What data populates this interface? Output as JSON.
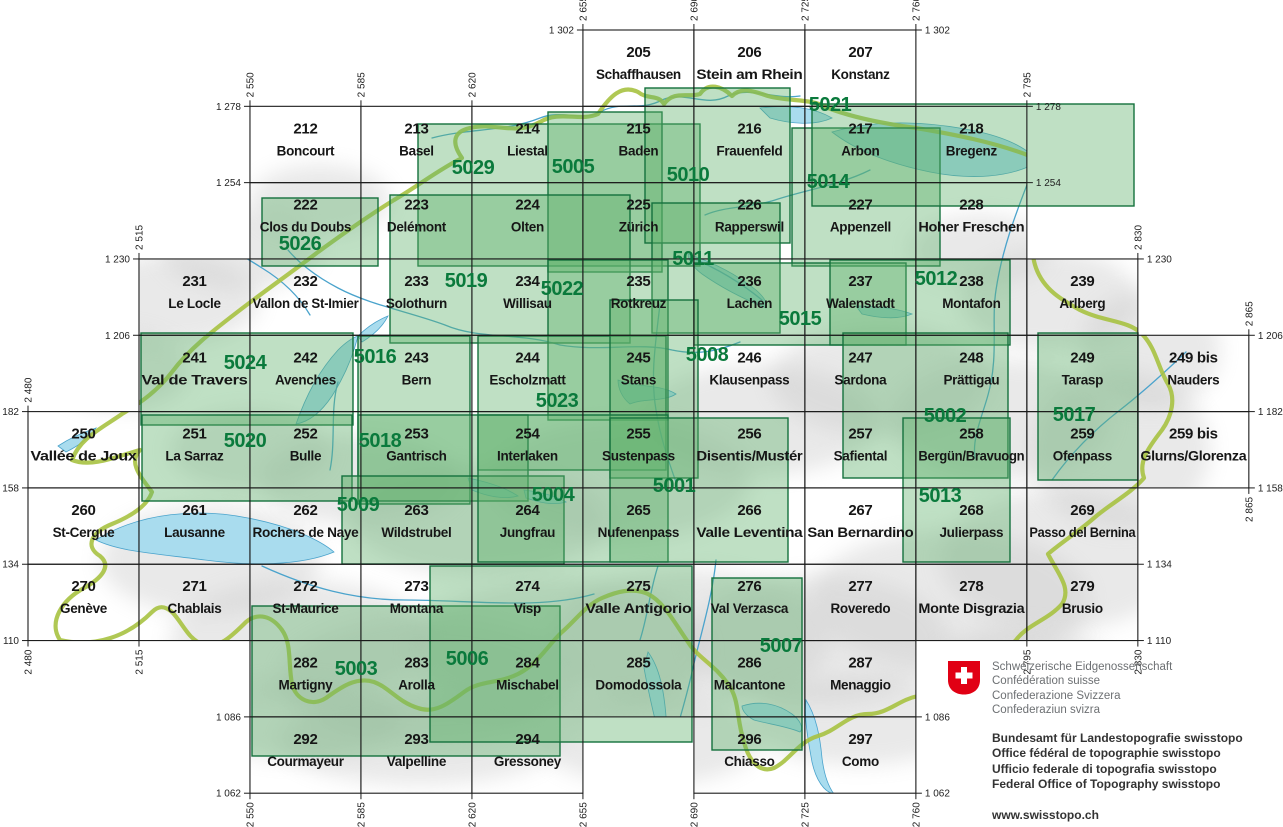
{
  "map": {
    "sheets": [
      {
        "num": "205",
        "name": "Schaffhausen",
        "e": 2655,
        "n": 1302
      },
      {
        "num": "206",
        "name": "Stein am Rhein",
        "e": 2690,
        "n": 1302
      },
      {
        "num": "207",
        "name": "Konstanz",
        "e": 2725,
        "n": 1302
      },
      {
        "num": "212",
        "name": "Boncourt",
        "e": 2550,
        "n": 1278
      },
      {
        "num": "213",
        "name": "Basel",
        "e": 2585,
        "n": 1278
      },
      {
        "num": "214",
        "name": "Liestal",
        "e": 2620,
        "n": 1278
      },
      {
        "num": "215",
        "name": "Baden",
        "e": 2655,
        "n": 1278
      },
      {
        "num": "216",
        "name": "Frauenfeld",
        "e": 2690,
        "n": 1278
      },
      {
        "num": "217",
        "name": "Arbon",
        "e": 2725,
        "n": 1278
      },
      {
        "num": "218",
        "name": "Bregenz",
        "e": 2760,
        "n": 1278
      },
      {
        "num": "222",
        "name": "Clos du Doubs",
        "e": 2550,
        "n": 1254
      },
      {
        "num": "223",
        "name": "Delémont",
        "e": 2585,
        "n": 1254
      },
      {
        "num": "224",
        "name": "Olten",
        "e": 2620,
        "n": 1254
      },
      {
        "num": "225",
        "name": "Zürich",
        "e": 2655,
        "n": 1254
      },
      {
        "num": "226",
        "name": "Rapperswil",
        "e": 2690,
        "n": 1254
      },
      {
        "num": "227",
        "name": "Appenzell",
        "e": 2725,
        "n": 1254
      },
      {
        "num": "228",
        "name": "Hoher Freschen",
        "e": 2760,
        "n": 1254
      },
      {
        "num": "231",
        "name": "Le Locle",
        "e": 2515,
        "n": 1230
      },
      {
        "num": "232",
        "name": "Vallon de St-Imier",
        "e": 2550,
        "n": 1230
      },
      {
        "num": "233",
        "name": "Solothurn",
        "e": 2585,
        "n": 1230
      },
      {
        "num": "234",
        "name": "Willisau",
        "e": 2620,
        "n": 1230
      },
      {
        "num": "235",
        "name": "Rotkreuz",
        "e": 2655,
        "n": 1230
      },
      {
        "num": "236",
        "name": "Lachen",
        "e": 2690,
        "n": 1230
      },
      {
        "num": "237",
        "name": "Walenstadt",
        "e": 2725,
        "n": 1230
      },
      {
        "num": "238",
        "name": "Montafon",
        "e": 2760,
        "n": 1230
      },
      {
        "num": "239",
        "name": "Arlberg",
        "e": 2795,
        "n": 1230
      },
      {
        "num": "241",
        "name": "Val de Travers",
        "e": 2515,
        "n": 1206
      },
      {
        "num": "242",
        "name": "Avenches",
        "e": 2550,
        "n": 1206
      },
      {
        "num": "243",
        "name": "Bern",
        "e": 2585,
        "n": 1206
      },
      {
        "num": "244",
        "name": "Escholzmatt",
        "e": 2620,
        "n": 1206
      },
      {
        "num": "245",
        "name": "Stans",
        "e": 2655,
        "n": 1206
      },
      {
        "num": "246",
        "name": "Klausenpass",
        "e": 2690,
        "n": 1206
      },
      {
        "num": "247",
        "name": "Sardona",
        "e": 2725,
        "n": 1206
      },
      {
        "num": "248",
        "name": "Prättigau",
        "e": 2760,
        "n": 1206
      },
      {
        "num": "249",
        "name": "Tarasp",
        "e": 2795,
        "n": 1206
      },
      {
        "num": "249 bis",
        "name": "Nauders",
        "e": 2830,
        "n": 1206
      },
      {
        "num": "250",
        "name": "Vallée de Joux",
        "e": 2480,
        "n": 1182
      },
      {
        "num": "251",
        "name": "La Sarraz",
        "e": 2515,
        "n": 1182
      },
      {
        "num": "252",
        "name": "Bulle",
        "e": 2550,
        "n": 1182
      },
      {
        "num": "253",
        "name": "Gantrisch",
        "e": 2585,
        "n": 1182
      },
      {
        "num": "254",
        "name": "Interlaken",
        "e": 2620,
        "n": 1182
      },
      {
        "num": "255",
        "name": "Sustenpass",
        "e": 2655,
        "n": 1182
      },
      {
        "num": "256",
        "name": "Disentis/Mustér",
        "e": 2690,
        "n": 1182
      },
      {
        "num": "257",
        "name": "Safiental",
        "e": 2725,
        "n": 1182
      },
      {
        "num": "258",
        "name": "Bergün/Bravuogn",
        "e": 2760,
        "n": 1182
      },
      {
        "num": "259",
        "name": "Ofenpass",
        "e": 2795,
        "n": 1182
      },
      {
        "num": "259 bis",
        "name": "Glurns/Glorenza",
        "e": 2830,
        "n": 1182
      },
      {
        "num": "260",
        "name": "St-Cergue",
        "e": 2480,
        "n": 1158
      },
      {
        "num": "261",
        "name": "Lausanne",
        "e": 2515,
        "n": 1158
      },
      {
        "num": "262",
        "name": "Rochers de Naye",
        "e": 2550,
        "n": 1158
      },
      {
        "num": "263",
        "name": "Wildstrubel",
        "e": 2585,
        "n": 1158
      },
      {
        "num": "264",
        "name": "Jungfrau",
        "e": 2620,
        "n": 1158
      },
      {
        "num": "265",
        "name": "Nufenenpass",
        "e": 2655,
        "n": 1158
      },
      {
        "num": "266",
        "name": "Valle Leventina",
        "e": 2690,
        "n": 1158
      },
      {
        "num": "267",
        "name": "San Bernardino",
        "e": 2725,
        "n": 1158
      },
      {
        "num": "268",
        "name": "Julierpass",
        "e": 2760,
        "n": 1158
      },
      {
        "num": "269",
        "name": "Passo del Bernina",
        "e": 2795,
        "n": 1158
      },
      {
        "num": "270",
        "name": "Genève",
        "e": 2480,
        "n": 1134
      },
      {
        "num": "271",
        "name": "Chablais",
        "e": 2515,
        "n": 1134
      },
      {
        "num": "272",
        "name": "St-Maurice",
        "e": 2550,
        "n": 1134
      },
      {
        "num": "273",
        "name": "Montana",
        "e": 2585,
        "n": 1134
      },
      {
        "num": "274",
        "name": "Visp",
        "e": 2620,
        "n": 1134
      },
      {
        "num": "275",
        "name": "Valle Antigorio",
        "e": 2655,
        "n": 1134
      },
      {
        "num": "276",
        "name": "Val Verzasca",
        "e": 2690,
        "n": 1134
      },
      {
        "num": "277",
        "name": "Roveredo",
        "e": 2725,
        "n": 1134
      },
      {
        "num": "278",
        "name": "Monte Disgrazia",
        "e": 2760,
        "n": 1134
      },
      {
        "num": "279",
        "name": "Brusio",
        "e": 2795,
        "n": 1134
      },
      {
        "num": "282",
        "name": "Martigny",
        "e": 2550,
        "n": 1110
      },
      {
        "num": "283",
        "name": "Arolla",
        "e": 2585,
        "n": 1110
      },
      {
        "num": "284",
        "name": "Mischabel",
        "e": 2620,
        "n": 1110
      },
      {
        "num": "285",
        "name": "Domodossola",
        "e": 2655,
        "n": 1110
      },
      {
        "num": "286",
        "name": "Malcantone",
        "e": 2690,
        "n": 1110
      },
      {
        "num": "287",
        "name": "Menaggio",
        "e": 2725,
        "n": 1110
      },
      {
        "num": "292",
        "name": "Courmayeur",
        "e": 2550,
        "n": 1086
      },
      {
        "num": "293",
        "name": "Valpelline",
        "e": 2585,
        "n": 1086
      },
      {
        "num": "294",
        "name": "Gressoney",
        "e": 2620,
        "n": 1086
      },
      {
        "num": "296",
        "name": "Chiasso",
        "e": 2690,
        "n": 1086
      },
      {
        "num": "297",
        "name": "Como",
        "e": 2725,
        "n": 1086
      }
    ],
    "composites": [
      {
        "num": "5029",
        "x": 418,
        "y": 124,
        "w": 282,
        "h": 142,
        "lx": 473,
        "ly": 167
      },
      {
        "num": "5005",
        "x": 548,
        "y": 112,
        "w": 114,
        "h": 160,
        "lx": 573,
        "ly": 166
      },
      {
        "num": "5010",
        "x": 645,
        "y": 88,
        "w": 145,
        "h": 155,
        "lx": 688,
        "ly": 174
      },
      {
        "num": "5014",
        "x": 792,
        "y": 128,
        "w": 148,
        "h": 138,
        "lx": 828,
        "ly": 181
      },
      {
        "num": "5021",
        "x": 812,
        "y": 104,
        "w": 322,
        "h": 102,
        "lx": 830,
        "ly": 104
      },
      {
        "num": "5026",
        "x": 262,
        "y": 198,
        "w": 116,
        "h": 68,
        "lx": 300,
        "ly": 243
      },
      {
        "num": "5019",
        "x": 390,
        "y": 195,
        "w": 240,
        "h": 148,
        "lx": 466,
        "ly": 280
      },
      {
        "num": "5011",
        "x": 652,
        "y": 203,
        "w": 128,
        "h": 130,
        "lx": 693,
        "ly": 258
      },
      {
        "num": "5022",
        "x": 548,
        "y": 260,
        "w": 120,
        "h": 160,
        "lx": 562,
        "ly": 288
      },
      {
        "num": "5015",
        "x": 694,
        "y": 263,
        "w": 212,
        "h": 82,
        "lx": 800,
        "ly": 318
      },
      {
        "num": "5012",
        "x": 830,
        "y": 260,
        "w": 180,
        "h": 85,
        "lx": 936,
        "ly": 278
      },
      {
        "num": "5024",
        "x": 141,
        "y": 333,
        "w": 212,
        "h": 92,
        "lx": 245,
        "ly": 362
      },
      {
        "num": "5016",
        "x": 358,
        "y": 336,
        "w": 112,
        "h": 168,
        "lx": 375,
        "ly": 356
      },
      {
        "num": "5023",
        "x": 478,
        "y": 336,
        "w": 188,
        "h": 134,
        "lx": 557,
        "ly": 400
      },
      {
        "num": "5008",
        "x": 610,
        "y": 300,
        "w": 88,
        "h": 178,
        "lx": 707,
        "ly": 354
      },
      {
        "num": "5002",
        "x": 843,
        "y": 333,
        "w": 165,
        "h": 145,
        "lx": 945,
        "ly": 415
      },
      {
        "num": "5017",
        "x": 1038,
        "y": 333,
        "w": 100,
        "h": 147,
        "lx": 1074,
        "ly": 414
      },
      {
        "num": "5020",
        "x": 142,
        "y": 415,
        "w": 210,
        "h": 86,
        "lx": 245,
        "ly": 440
      },
      {
        "num": "5018",
        "x": 358,
        "y": 415,
        "w": 170,
        "h": 86,
        "lx": 380,
        "ly": 440
      },
      {
        "num": "5009",
        "x": 342,
        "y": 476,
        "w": 222,
        "h": 88,
        "lx": 358,
        "ly": 504
      },
      {
        "num": "5004",
        "x": 478,
        "y": 415,
        "w": 190,
        "h": 147,
        "lx": 553,
        "ly": 494
      },
      {
        "num": "5001",
        "x": 610,
        "y": 418,
        "w": 178,
        "h": 144,
        "lx": 674,
        "ly": 485
      },
      {
        "num": "5013",
        "x": 903,
        "y": 418,
        "w": 107,
        "h": 144,
        "lx": 940,
        "ly": 495
      },
      {
        "num": "5007",
        "x": 712,
        "y": 578,
        "w": 90,
        "h": 172,
        "lx": 781,
        "ly": 645
      },
      {
        "num": "5003",
        "x": 252,
        "y": 606,
        "w": 308,
        "h": 150,
        "lx": 356,
        "ly": 668
      },
      {
        "num": "5006",
        "x": 430,
        "y": 566,
        "w": 262,
        "h": 176,
        "lx": 467,
        "ly": 658
      }
    ],
    "northings": [
      {
        "v": "1 302",
        "n": 1302,
        "w": 2655,
        "e": 2760
      },
      {
        "v": "1 278",
        "n": 1278,
        "w": 2550,
        "e": 2795
      },
      {
        "v": "1 254",
        "n": 1254,
        "w": 2550,
        "e": 2795
      },
      {
        "v": "1 230",
        "n": 1230,
        "w": 2515,
        "e": 2830
      },
      {
        "v": "1 206",
        "n": 1206,
        "w": 2515,
        "e": 2865
      },
      {
        "v": "1 182",
        "n": 1182,
        "w": 2480,
        "e": 2865
      },
      {
        "v": "1 158",
        "n": 1158,
        "w": 2480,
        "e": 2865
      },
      {
        "v": "1 134",
        "n": 1134,
        "w": 2480,
        "e": 2830
      },
      {
        "v": "1 110",
        "n": 1110,
        "w": 2480,
        "e": 2830
      },
      {
        "v": "1 086",
        "n": 1086,
        "w": 2550,
        "e": 2760
      },
      {
        "v": "1 062",
        "n": 1062,
        "w": 2550,
        "e": 2760
      }
    ],
    "eastings": [
      {
        "v": "2 480",
        "e": 2480,
        "top": 1182,
        "bot": 1110
      },
      {
        "v": "2 515",
        "e": 2515,
        "top": 1230,
        "bot": 1110
      },
      {
        "v": "2 550",
        "e": 2550,
        "top": 1278,
        "bot": 1062
      },
      {
        "v": "2 585",
        "e": 2585,
        "top": 1278,
        "bot": 1062
      },
      {
        "v": "2 620",
        "e": 2620,
        "top": 1278,
        "bot": 1062
      },
      {
        "v": "2 655",
        "e": 2655,
        "top": 1302,
        "bot": 1062
      },
      {
        "v": "2 690",
        "e": 2690,
        "top": 1302,
        "bot": 1062
      },
      {
        "v": "2 725",
        "e": 2725,
        "top": 1302,
        "bot": 1062
      },
      {
        "v": "2 760",
        "e": 2760,
        "top": 1302,
        "bot": 1062
      },
      {
        "v": "2 795",
        "e": 2795,
        "top": 1278,
        "bot": 1110
      },
      {
        "v": "2 830",
        "e": 2830,
        "top": 1230,
        "bot": 1110
      },
      {
        "v": "2 865",
        "e": 2865,
        "top": 1206,
        "bot": 1158
      }
    ]
  },
  "logo": {
    "confederation_lines": [
      "Schweizerische Eidgenossenschaft",
      "Confédération suisse",
      "Confederazione Svizzera",
      "Confederaziun svizra"
    ],
    "office_lines": [
      "Bundesamt für Landestopografie swisstopo",
      "Office fédéral de topographie swisstopo",
      "Ufficio federale di topografia swisstopo",
      "Federal Office of Topography swisstopo"
    ],
    "url": "www.swisstopo.ch"
  },
  "colors": {
    "composite_green": "#0a7a3c",
    "overlay_fill": "rgba(96,178,108,0.40)",
    "overlay_stroke": "#14713d",
    "border_green": "#a8c242",
    "water_fill": "#a9dcee",
    "water_line": "#4aa3cc",
    "river_blue": "#4aa3cc",
    "logo_red": "#e10014",
    "grid_black": "#1b1b1b"
  }
}
